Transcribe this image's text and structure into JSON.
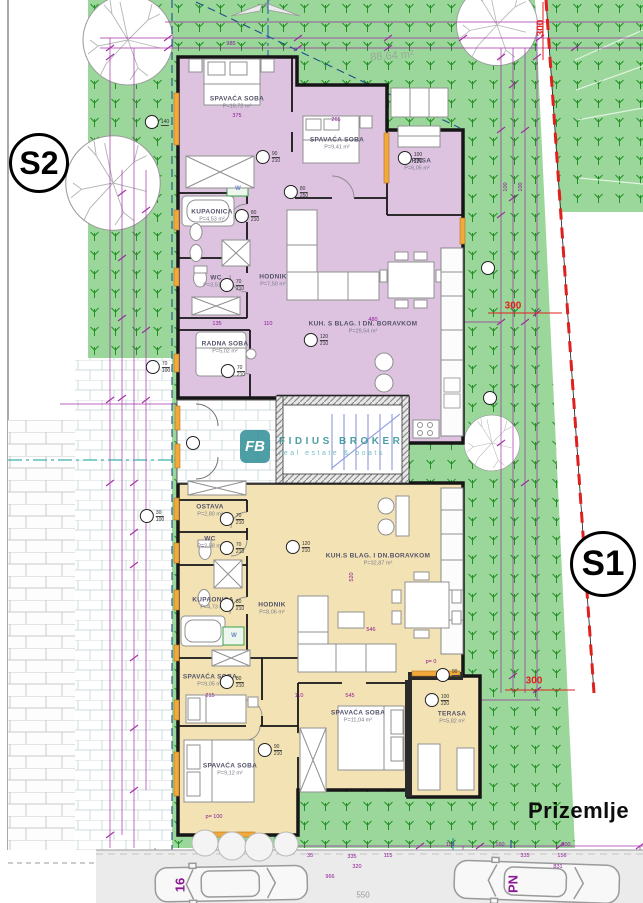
{
  "floor_label": "Prizemlje",
  "badges": {
    "s1": "S1",
    "s2": "S2"
  },
  "watermark": {
    "logo_text": "FB",
    "title": "FIDIUS BROKER",
    "subtitle": "real estate & boats"
  },
  "colors": {
    "apartment_s2_fill": "#ddc3e0",
    "apartment_s1_fill": "#f3e3b4",
    "site_green": "#9bd79b",
    "grass_symbol_green": "#239023",
    "dimension_purple": "#8d1793",
    "boundary_red": "#e0201d",
    "watermark_teal": "#2e8f96",
    "window_orange": "#f2a93b"
  },
  "rooms": [
    {
      "unit": "S2",
      "name": "SPAVAĆA SOBA",
      "area": "P=10,72 m²",
      "x": 237,
      "y": 103
    },
    {
      "unit": "S2",
      "name": "SPAVAĆA SOBA",
      "area": "P=9,41 m²",
      "x": 337,
      "y": 144
    },
    {
      "unit": "S2",
      "name": "TERASA",
      "area": "P=6,05 m²",
      "x": 417,
      "y": 165
    },
    {
      "unit": "S2",
      "name": "KUPAONICA",
      "area": "P=4,53 m²",
      "x": 212,
      "y": 216
    },
    {
      "unit": "S2",
      "name": "WC",
      "area": "P=3,51 m²",
      "x": 216,
      "y": 282
    },
    {
      "unit": "S2",
      "name": "HODNIK",
      "area": "P=7,50 m²",
      "x": 273,
      "y": 281
    },
    {
      "unit": "S2",
      "name": "RADNA SOBA",
      "area": "P=5,02 m²",
      "x": 225,
      "y": 348
    },
    {
      "unit": "S2",
      "name": "KUH. S BLAG. I DN. BORAVKOM",
      "area": "P=29,54 m²",
      "x": 363,
      "y": 328
    },
    {
      "unit": "S1",
      "name": "OSTAVA",
      "area": "P=2,80 m²",
      "x": 210,
      "y": 511
    },
    {
      "unit": "S1",
      "name": "WC",
      "area": "P=2,58 m²",
      "x": 210,
      "y": 543
    },
    {
      "unit": "S1",
      "name": "KUPAONICA",
      "area": "P=4,73 m²",
      "x": 213,
      "y": 604
    },
    {
      "unit": "S1",
      "name": "HODNIK",
      "area": "P=8,06 m²",
      "x": 272,
      "y": 609
    },
    {
      "unit": "S1",
      "name": "KUH.S BLAG. I DN.BORAVKOM",
      "area": "P=32,87 m²",
      "x": 378,
      "y": 560
    },
    {
      "unit": "S1",
      "name": "SPAVAĆA SOBA",
      "area": "P=9,05 m²",
      "x": 210,
      "y": 681
    },
    {
      "unit": "S1",
      "name": "SPAVAĆA SOBA",
      "area": "P=9,12 m²",
      "x": 230,
      "y": 770
    },
    {
      "unit": "S1",
      "name": "SPAVAĆA SOBA",
      "area": "P=11,04 m²",
      "x": 358,
      "y": 717
    },
    {
      "unit": "S1",
      "name": "TERASA",
      "area": "P=5,82 m²",
      "x": 452,
      "y": 718
    }
  ],
  "dims": [
    {
      "t": "985",
      "x": 231,
      "y": 44
    },
    {
      "t": "375",
      "x": 237,
      "y": 116
    },
    {
      "t": "265",
      "x": 336,
      "y": 120
    },
    {
      "t": "480",
      "x": 373,
      "y": 320
    },
    {
      "t": "135",
      "x": 217,
      "y": 324
    },
    {
      "t": "110",
      "x": 268,
      "y": 324
    },
    {
      "t": "520",
      "x": 352,
      "y": 577,
      "rot": -90
    },
    {
      "t": "546",
      "x": 371,
      "y": 630
    },
    {
      "t": "215",
      "x": 210,
      "y": 696
    },
    {
      "t": "110",
      "x": 299,
      "y": 696
    },
    {
      "t": "545",
      "x": 350,
      "y": 696
    },
    {
      "t": "p= 100",
      "x": 214,
      "y": 817
    },
    {
      "t": "p= 0",
      "x": 431,
      "y": 662
    },
    {
      "t": "100",
      "x": 506,
      "y": 187,
      "rot": -90
    },
    {
      "t": "100",
      "x": 521,
      "y": 187,
      "rot": -90
    },
    {
      "t": "110",
      "x": 450,
      "y": 845
    },
    {
      "t": "160",
      "x": 500,
      "y": 845
    },
    {
      "t": "500",
      "x": 566,
      "y": 845
    },
    {
      "t": "35",
      "x": 310,
      "y": 856
    },
    {
      "t": "115",
      "x": 388,
      "y": 856
    },
    {
      "t": "335",
      "x": 352,
      "y": 857
    },
    {
      "t": "335",
      "x": 525,
      "y": 856
    },
    {
      "t": "156",
      "x": 562,
      "y": 856
    },
    {
      "t": "320",
      "x": 357,
      "y": 867
    },
    {
      "t": "831",
      "x": 558,
      "y": 867
    },
    {
      "t": "966",
      "x": 330,
      "y": 877
    },
    {
      "t": "550",
      "x": 363,
      "y": 895,
      "cls": "gray"
    },
    {
      "t": "88,64 m²",
      "x": 392,
      "y": 56,
      "cls": "area",
      "rot": -4
    },
    {
      "t": "300",
      "x": 541,
      "y": 28,
      "cls": "red",
      "rot": -90
    },
    {
      "t": "300",
      "x": 513,
      "y": 306,
      "cls": "red"
    },
    {
      "t": "300",
      "x": 534,
      "y": 681,
      "cls": "red"
    },
    {
      "t": "W",
      "x": 238,
      "y": 189,
      "cls": "w"
    },
    {
      "t": "W",
      "x": 234,
      "y": 636,
      "cls": "w"
    },
    {
      "t": "16",
      "x": 180,
      "y": 885,
      "cls": "big",
      "rot": -90
    },
    {
      "t": "PN",
      "x": 513,
      "y": 884,
      "cls": "big",
      "rot": -90
    }
  ],
  "markers": [
    {
      "x": 410,
      "y": 158,
      "a": "100",
      "b": "220"
    },
    {
      "x": 247,
      "y": 216,
      "a": "80",
      "b": "210"
    },
    {
      "x": 232,
      "y": 285,
      "a": "70",
      "b": "210"
    },
    {
      "x": 233,
      "y": 371,
      "a": "70",
      "b": "210"
    },
    {
      "x": 316,
      "y": 340,
      "a": "120",
      "b": "210"
    },
    {
      "x": 268,
      "y": 157,
      "a": "90",
      "b": "210"
    },
    {
      "x": 296,
      "y": 192,
      "a": "80",
      "b": "250"
    },
    {
      "x": 232,
      "y": 519,
      "a": "70",
      "b": "210"
    },
    {
      "x": 232,
      "y": 548,
      "a": "70",
      "b": "210"
    },
    {
      "x": 298,
      "y": 547,
      "a": "120",
      "b": "210"
    },
    {
      "x": 232,
      "y": 605,
      "a": "80",
      "b": "210"
    },
    {
      "x": 232,
      "y": 682,
      "a": "80",
      "b": "210"
    },
    {
      "x": 270,
      "y": 750,
      "a": "90",
      "b": "210"
    },
    {
      "x": 437,
      "y": 700,
      "a": "100",
      "b": "220"
    },
    {
      "x": 448,
      "y": 675,
      "a": "90",
      "b": "210"
    },
    {
      "x": 157,
      "y": 122,
      "a": "140",
      "b": ""
    },
    {
      "x": 158,
      "y": 367,
      "a": "70",
      "b": "100"
    },
    {
      "x": 152,
      "y": 516,
      "a": "30",
      "b": "100"
    },
    {
      "x": 193,
      "y": 443,
      "a": "",
      "b": ""
    },
    {
      "x": 488,
      "y": 268,
      "a": "",
      "b": ""
    },
    {
      "x": 490,
      "y": 398,
      "a": "",
      "b": ""
    }
  ]
}
